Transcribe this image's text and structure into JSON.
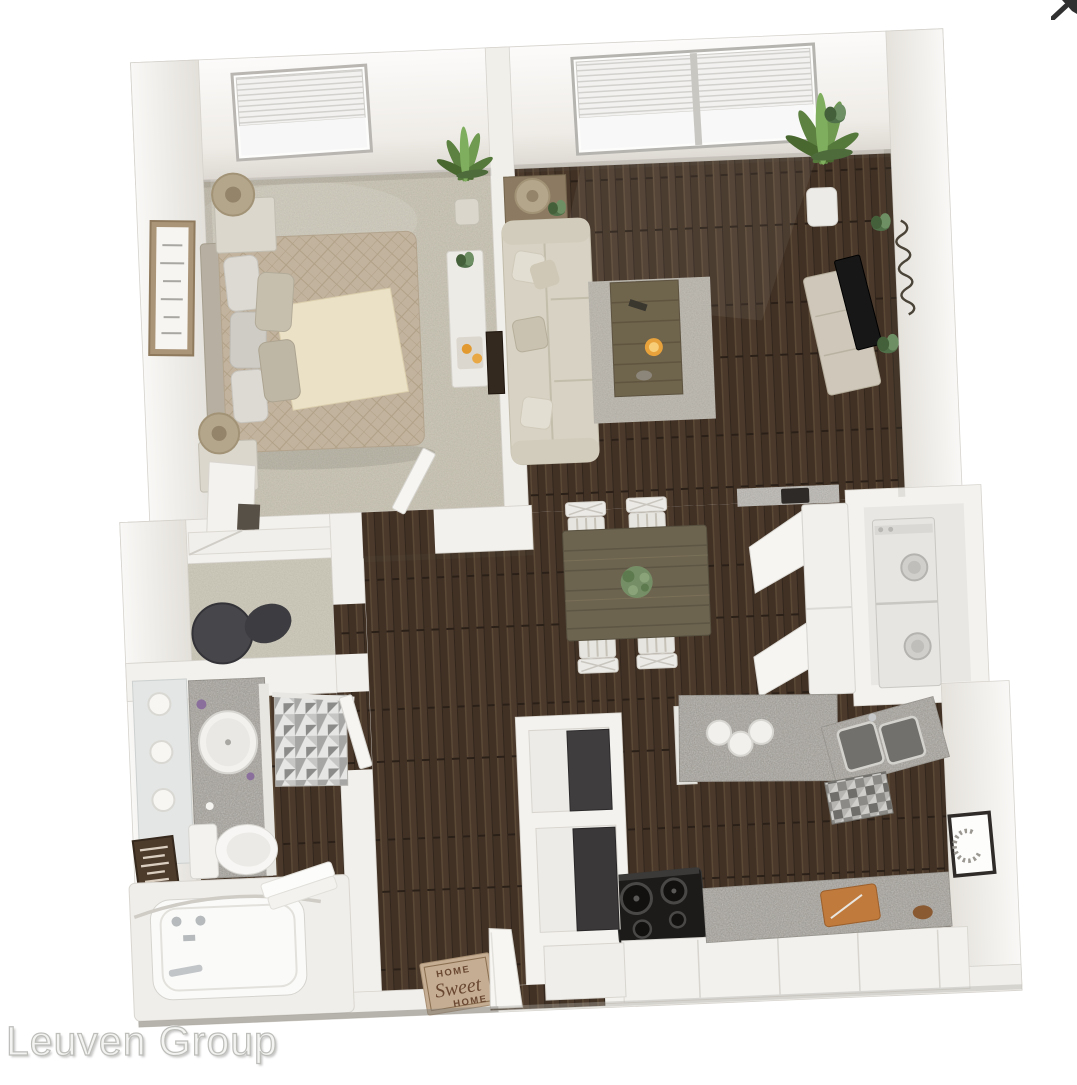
{
  "watermark": {
    "text": "Leuven Group",
    "color": "#c9c9c6"
  },
  "top_right_icon": {
    "name": "external-arrow",
    "color": "#303030"
  },
  "floor_plan": {
    "type": "3d-apartment-floor-plan-rendering",
    "door_mat": {
      "line1": "HOME",
      "line2": "Sweet",
      "line3": "HOME",
      "text_color": "#6a4832",
      "mat_color": "#c4ad92"
    },
    "colors": {
      "background": "#ffffff",
      "walls": "#f3f1ed",
      "hardwood": "#4a3a2c",
      "carpet": "#c8c3b2",
      "granite": "#a8a5a0",
      "sofa": "#d7d2c3",
      "bedding_tan": "#c2b39e",
      "plant_green": "#5d8140",
      "candle_orange": "#e8a23c",
      "appliance_black": "#1c1b1a",
      "appliance_white": "#e6e5e2"
    }
  }
}
